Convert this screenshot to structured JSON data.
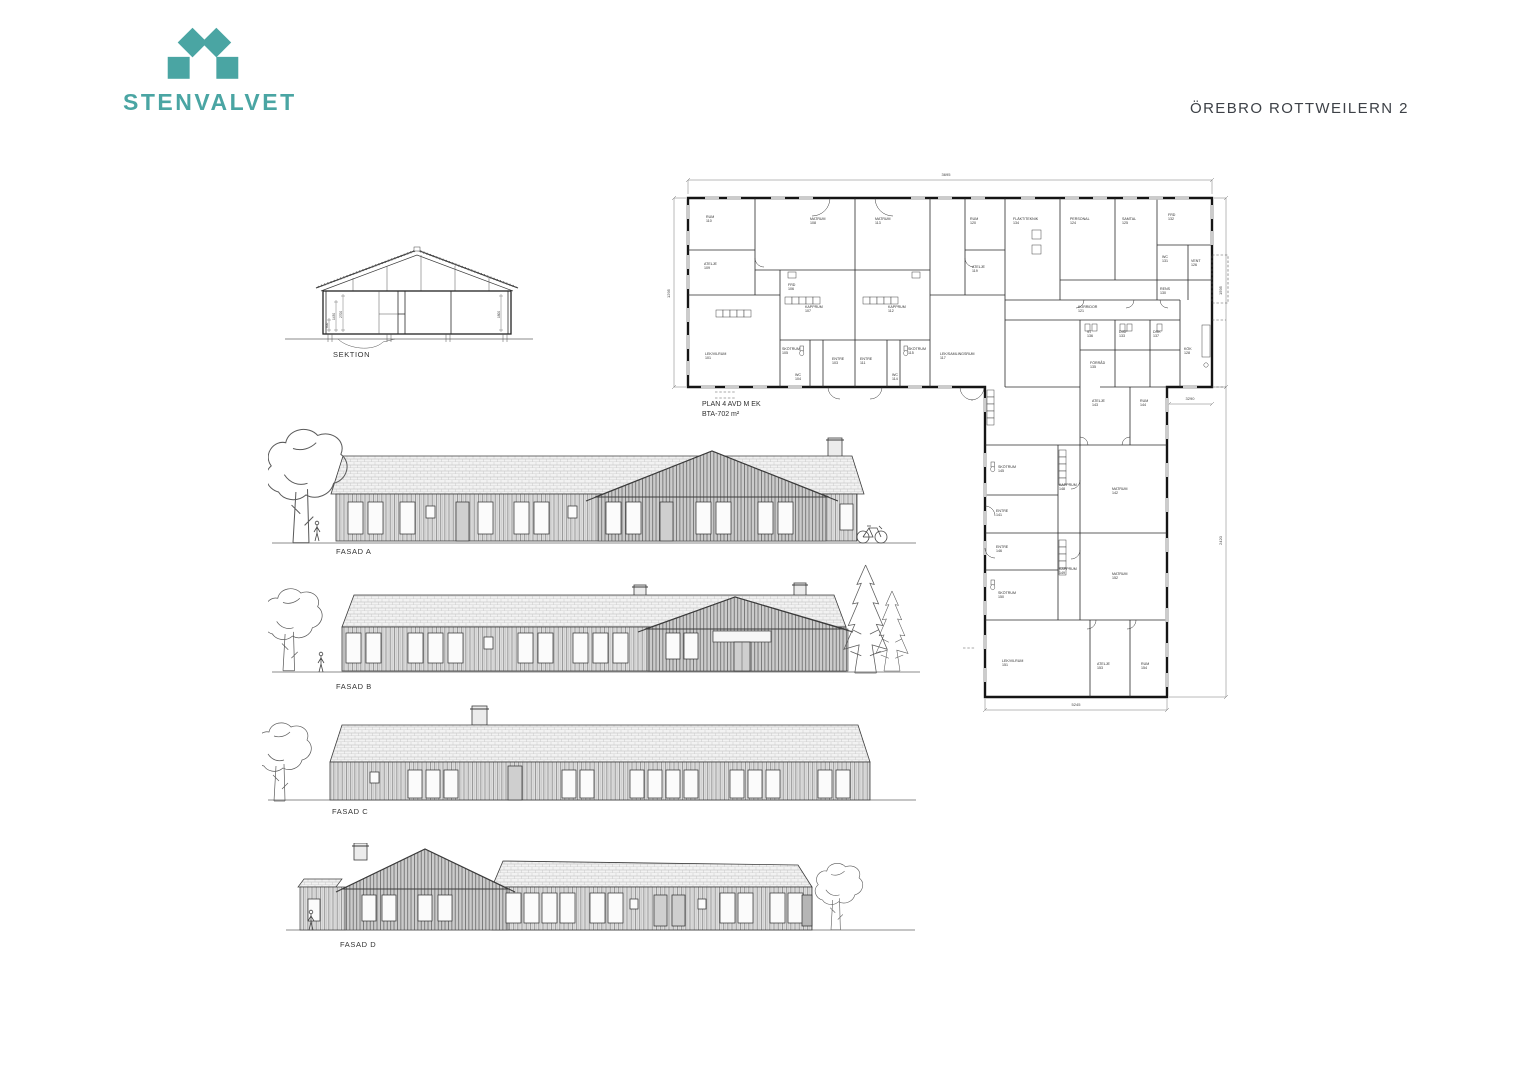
{
  "brand": {
    "name": "STENVALVET",
    "color": "#4aa5a3"
  },
  "header": {
    "project": "ÖREBRO ROTTWEILERN 2"
  },
  "sektion": {
    "label": "SEKTION",
    "dims": [
      "600",
      "1430",
      "2700",
      "1800"
    ]
  },
  "plan": {
    "title_line1": "PLAN 4 AVD M EK",
    "title_line2": "BTA-702 m²",
    "dims": {
      "top": "3695",
      "left": "1295",
      "right_band": "1595",
      "right_wing": "2420",
      "wing_top": "3290",
      "bottom": "5245"
    },
    "rooms_upper": [
      {
        "x": 46,
        "y": 68,
        "label": "RUM|110"
      },
      {
        "x": 44,
        "y": 115,
        "label": "ATELJE|109"
      },
      {
        "x": 150,
        "y": 70,
        "label": "MATRUM|108"
      },
      {
        "x": 215,
        "y": 70,
        "label": "MATRUM|113"
      },
      {
        "x": 145,
        "y": 158,
        "label": "KAPPRUM|107"
      },
      {
        "x": 228,
        "y": 158,
        "label": "KAPPRUM|112"
      },
      {
        "x": 122,
        "y": 200,
        "label": "SKÖTRUM|105"
      },
      {
        "x": 248,
        "y": 200,
        "label": "SKÖTRUM|115"
      },
      {
        "x": 172,
        "y": 210,
        "label": "ENTRE|103"
      },
      {
        "x": 200,
        "y": 210,
        "label": "ENTRE|111"
      },
      {
        "x": 45,
        "y": 205,
        "label": "LEK/VILRUM|101"
      },
      {
        "x": 135,
        "y": 226,
        "label": "WC|104"
      },
      {
        "x": 232,
        "y": 226,
        "label": "WC|114"
      },
      {
        "x": 128,
        "y": 136,
        "label": "FRD|106"
      },
      {
        "x": 310,
        "y": 70,
        "label": "RUM|120"
      },
      {
        "x": 312,
        "y": 118,
        "label": "ATELJE|119"
      },
      {
        "x": 280,
        "y": 205,
        "label": "LEK/SAMLINGSRUM|117"
      },
      {
        "x": 353,
        "y": 70,
        "label": "FLÄKT/TEKNIK|134"
      },
      {
        "x": 410,
        "y": 70,
        "label": "PERSONAL|124"
      },
      {
        "x": 462,
        "y": 70,
        "label": "SAMTAL|125"
      },
      {
        "x": 508,
        "y": 66,
        "label": "FRD|132"
      },
      {
        "x": 502,
        "y": 108,
        "label": "WC|131"
      },
      {
        "x": 531,
        "y": 112,
        "label": "VENT|126"
      },
      {
        "x": 500,
        "y": 140,
        "label": "RENS|130"
      },
      {
        "x": 418,
        "y": 158,
        "label": "KORRIDOR|121"
      },
      {
        "x": 427,
        "y": 183,
        "label": "ST|136"
      },
      {
        "x": 459,
        "y": 183,
        "label": "DISP|133"
      },
      {
        "x": 493,
        "y": 183,
        "label": "DRK|137"
      },
      {
        "x": 524,
        "y": 200,
        "label": "KÖK|128"
      },
      {
        "x": 430,
        "y": 214,
        "label": "FÖRRÅD|135"
      }
    ],
    "rooms_wing": [
      {
        "x": 432,
        "y": 252,
        "label": "ATELJE|143"
      },
      {
        "x": 480,
        "y": 252,
        "label": "RUM|144"
      },
      {
        "x": 338,
        "y": 318,
        "label": "SKÖTRUM|145"
      },
      {
        "x": 399,
        "y": 336,
        "label": "KAPPRUM|148"
      },
      {
        "x": 452,
        "y": 340,
        "label": "MATRUM|142"
      },
      {
        "x": 336,
        "y": 362,
        "label": "ENTRE|141"
      },
      {
        "x": 336,
        "y": 398,
        "label": "ENTRE|146"
      },
      {
        "x": 399,
        "y": 420,
        "label": "KAPPRUM|149"
      },
      {
        "x": 452,
        "y": 425,
        "label": "MATRUM|152"
      },
      {
        "x": 338,
        "y": 444,
        "label": "SKÖTRUM|150"
      },
      {
        "x": 342,
        "y": 512,
        "label": "LEK/VILRUM|151"
      },
      {
        "x": 437,
        "y": 515,
        "label": "ATELJE|153"
      },
      {
        "x": 481,
        "y": 515,
        "label": "RUM|154"
      }
    ]
  },
  "fasader": [
    {
      "label": "FASAD A"
    },
    {
      "label": "FASAD B"
    },
    {
      "label": "FASAD C"
    },
    {
      "label": "FASAD D"
    }
  ]
}
